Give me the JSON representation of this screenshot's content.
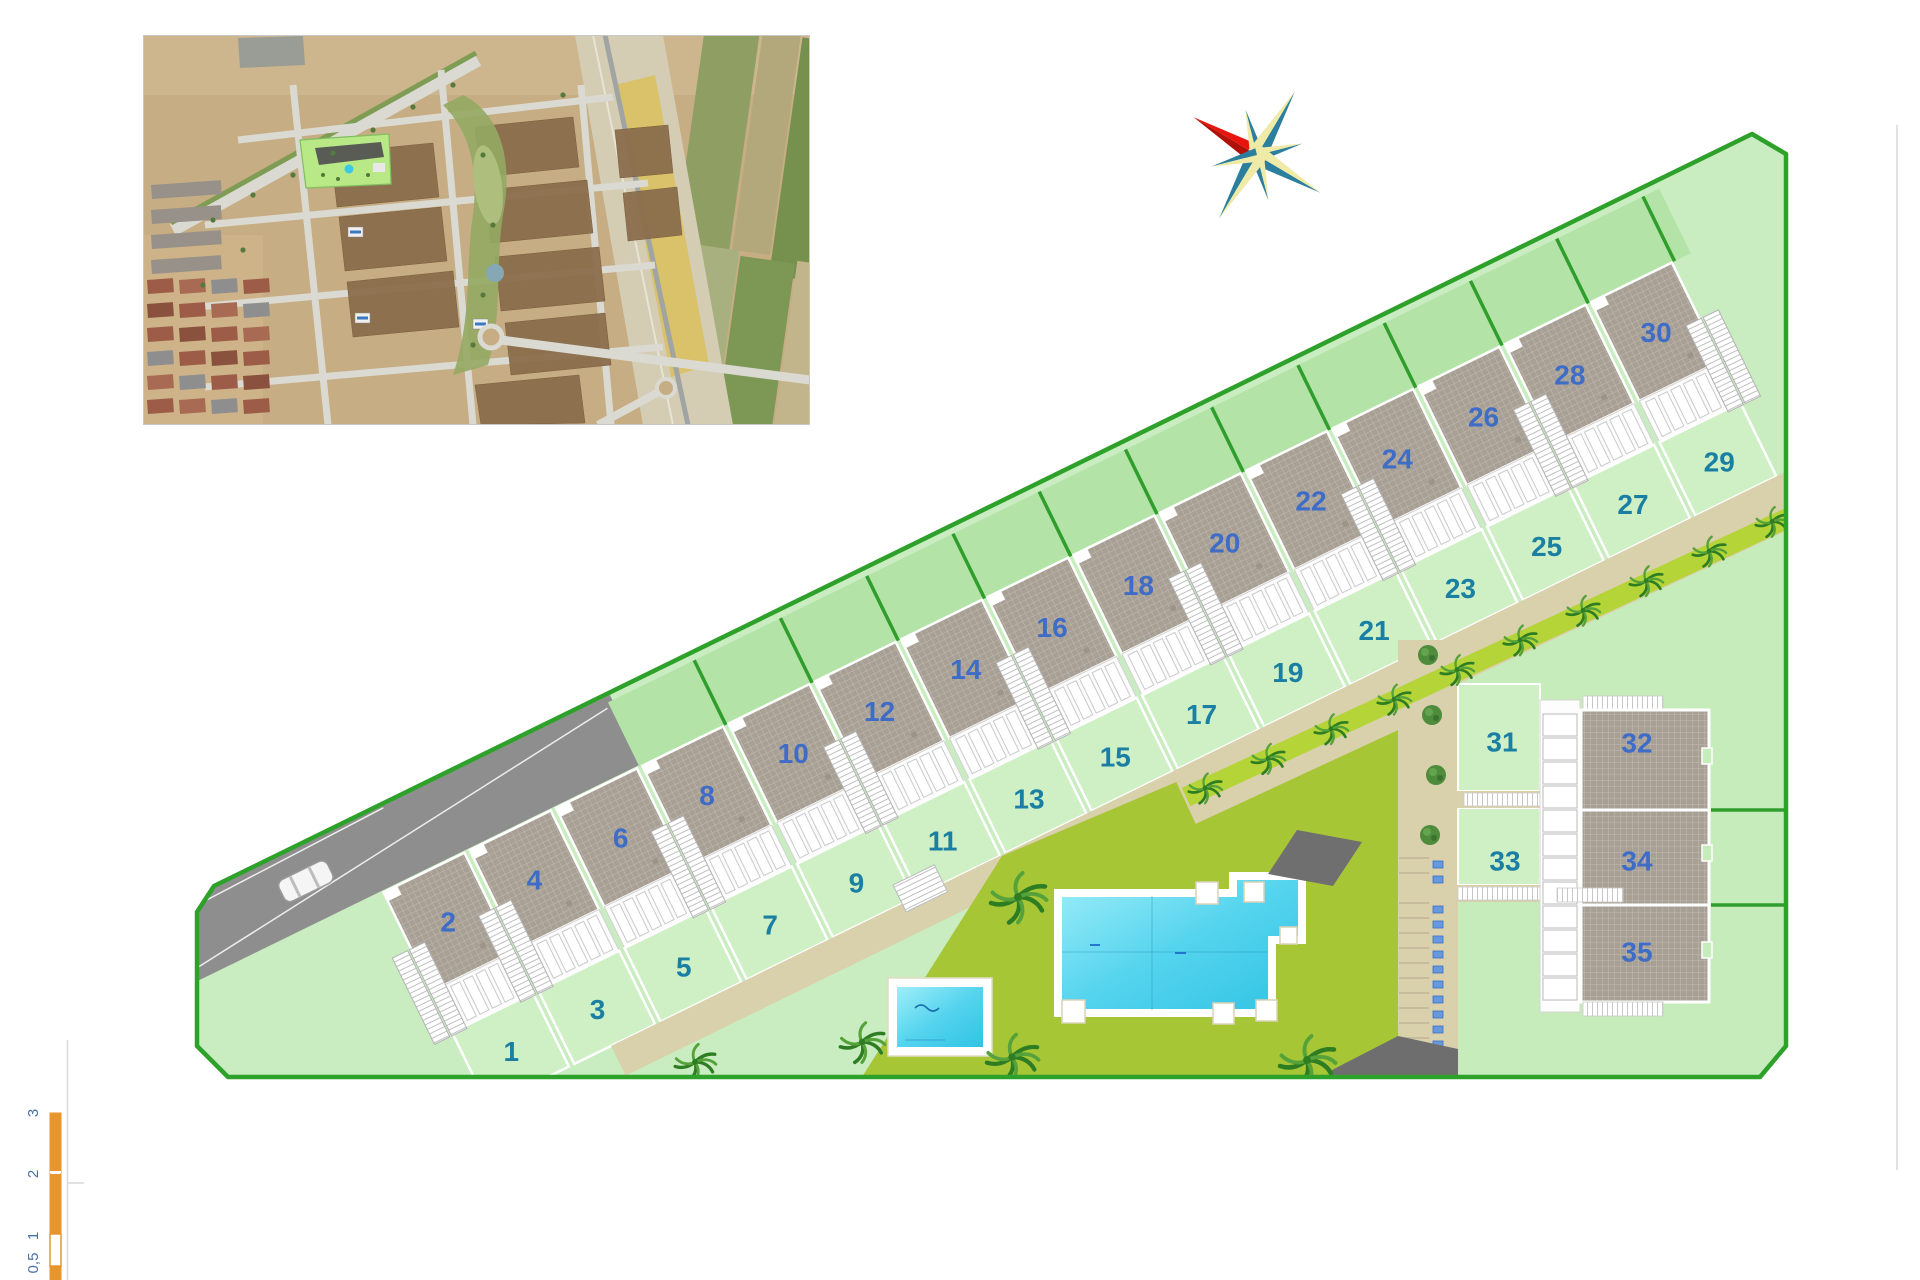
{
  "site_plan": {
    "main_row": {
      "roof_unit_numbers": [
        "2",
        "4",
        "6",
        "8",
        "10",
        "12",
        "14",
        "16",
        "18",
        "20",
        "22",
        "24",
        "26",
        "28",
        "30"
      ],
      "garden_unit_numbers": [
        "1",
        "3",
        "5",
        "7",
        "9",
        "11",
        "13",
        "15",
        "17",
        "19",
        "21",
        "23",
        "25",
        "27",
        "29"
      ]
    },
    "right_block": {
      "garden_unit_numbers": [
        "31",
        "33"
      ],
      "roof_unit_numbers": [
        "32",
        "34",
        "35"
      ]
    },
    "label_colors": {
      "roof_number": "#3e6cc6",
      "garden_number": "#1a7fa2"
    },
    "boundary_color": "#2ea12b",
    "lawn_color": "#a6c636",
    "pool_color": "#55d4ee",
    "path_color": "#d9d0ac"
  },
  "compass": {
    "icon": "compass-rose-icon",
    "north_arm_color": "#e8150e",
    "arm_dark_color": "#2b7f9d",
    "arm_light_color": "#efeaa6"
  },
  "inset": {
    "icon": "aerial-photo-inset"
  },
  "scale_bar": {
    "labels": [
      "3",
      "2",
      "1",
      "0,5"
    ],
    "bar_color": "#e8952e",
    "label_color": "#4a6fa5"
  }
}
